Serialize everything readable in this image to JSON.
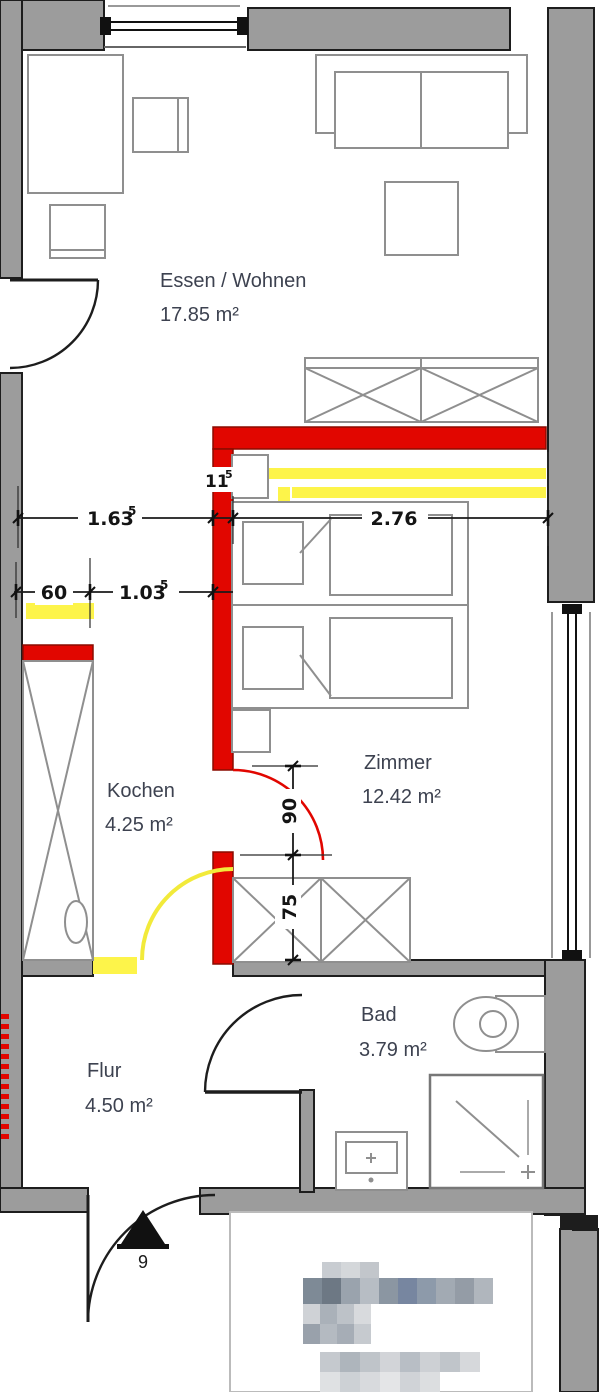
{
  "plan": {
    "rooms": [
      {
        "name": "Essen / Wohnen",
        "area": "17.85 m²"
      },
      {
        "name": "Zimmer",
        "area": "12.42 m²"
      },
      {
        "name": "Kochen",
        "area": "4.25 m²"
      },
      {
        "name": "Bad",
        "area": "3.79 m²"
      },
      {
        "name": "Flur",
        "area": "4.50 m²"
      }
    ],
    "dimensions": {
      "d163": {
        "v": "1.63",
        "sup": "5"
      },
      "d276": {
        "v": "2.76",
        "sup": ""
      },
      "d115": {
        "v": "11",
        "sup": "5"
      },
      "d60": {
        "v": "60",
        "sup": ""
      },
      "d103": {
        "v": "1.03",
        "sup": "5"
      },
      "d90": {
        "v": "90",
        "sup": ""
      },
      "d75": {
        "v": "75",
        "sup": ""
      },
      "entrance": {
        "v": "9",
        "sup": ""
      }
    },
    "colors": {
      "wall_gray": "#9c9c9c",
      "outline": "#1d1d1d",
      "modification_red": "#e10600",
      "modification_yellow": "#fdf44a",
      "room_label": "#3d4250",
      "dimension_text": "#141414",
      "furniture_stroke": "#8f8f8f"
    },
    "fixtures": [
      "sofa",
      "side-table",
      "dining-table",
      "chair",
      "wardrobe",
      "double-bed",
      "nightstand",
      "closet",
      "kitchen-tall-unit",
      "kitchen-sink",
      "toilet",
      "shower",
      "washbasin",
      "entrance-arrow",
      "pixelated-title-block"
    ]
  }
}
